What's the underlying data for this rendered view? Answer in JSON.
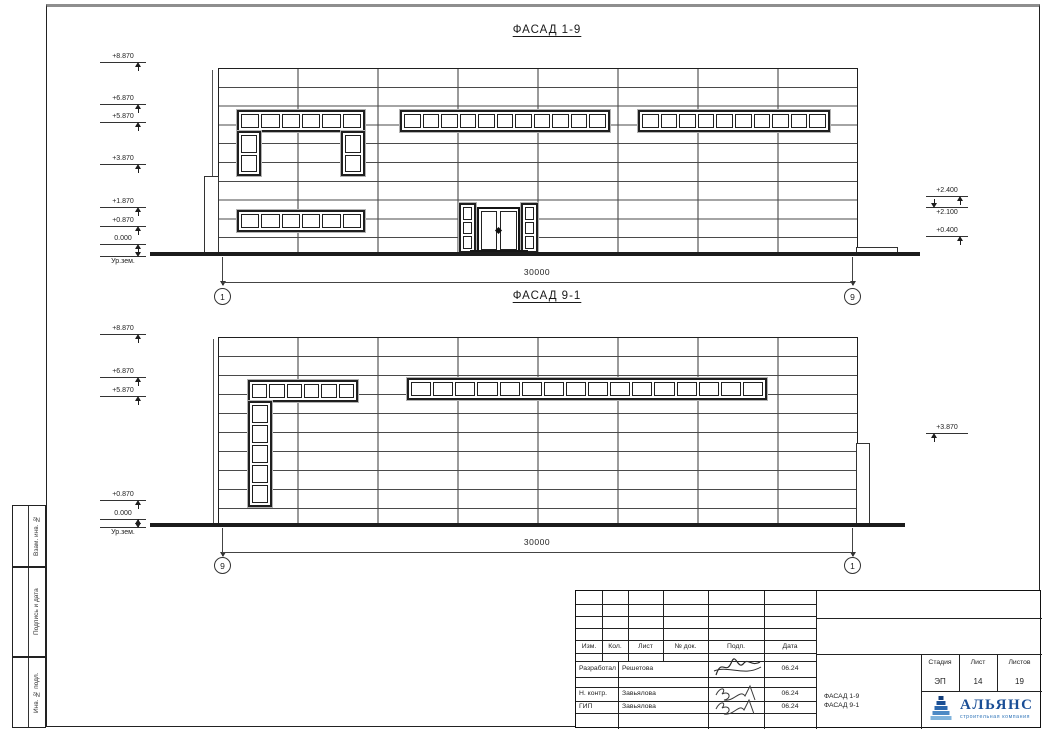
{
  "facade1": {
    "title": "ФАСАД 1-9",
    "dim": "30000",
    "axisL": "1",
    "axisR": "9",
    "elevL": [
      "+8.870",
      "+6.870",
      "+5.870",
      "+3.870",
      "+1.870",
      "+0.870",
      "0.000",
      "Ур.зем."
    ],
    "elevR": [
      "+2.400",
      "+2.100",
      "+0.400"
    ]
  },
  "facade2": {
    "title": "ФАСАД 9-1",
    "dim": "30000",
    "axisL": "9",
    "axisR": "1",
    "elevL": [
      "+8.870",
      "+6.870",
      "+5.870",
      "+0.870",
      "0.000",
      "Ур.зем."
    ],
    "elevR": [
      "+3.870"
    ]
  },
  "margin_stamps": [
    "Взам. инв. №",
    "Подпись и дата",
    "Инв. № подл."
  ],
  "titleblock": {
    "cols": [
      "Изм.",
      "Кол.",
      "Лист",
      "№ док.",
      "Подп.",
      "Дата"
    ],
    "rows": [
      {
        "role": "Разработал",
        "name": "Решетова",
        "date": "06.24"
      },
      {
        "role": "Н. контр.",
        "name": "Завьялова",
        "date": "06.24"
      },
      {
        "role": "ГИП",
        "name": "Завьялова",
        "date": "06.24"
      }
    ],
    "stage_label": "Стадия",
    "sheet_label": "Лист",
    "sheets_label": "Листов",
    "stage": "ЭП",
    "sheet": "14",
    "sheets": "19",
    "doc1": "ФАСАД 1-9",
    "doc2": "ФАСАД 9-1",
    "logo_name": "АЛЬЯНС",
    "logo_tagline": "строительная компания",
    "logo_color": "#1a4e96"
  }
}
